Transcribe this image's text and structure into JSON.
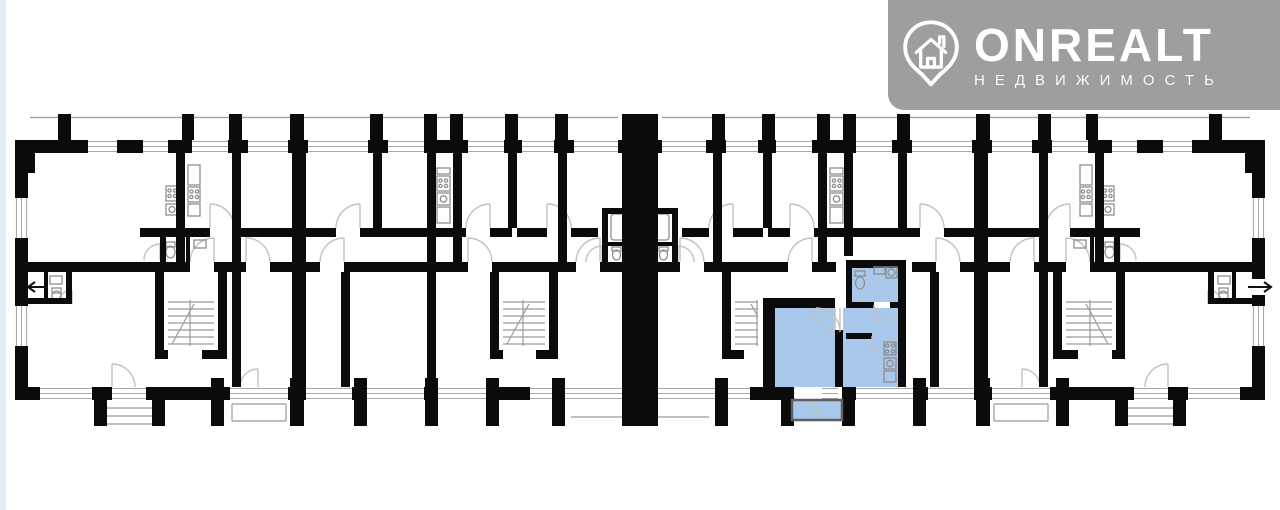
{
  "page": {
    "background_color": "#ffffff",
    "edge_strip_color": "#e4ecf6"
  },
  "watermark": {
    "brand": "ONREALT",
    "tagline": "НЕДВИЖИМОСТЬ",
    "background_color": "#9e9e9e",
    "text_color": "#ffffff",
    "icon": "location-pin-house-icon"
  },
  "floor_plan": {
    "wall_color": "#0b0b0b",
    "window_line_color": "#a9a9a9",
    "rail_line_color": "#9b9b9b",
    "door_arc_color": "#c2c2c2",
    "fixture_line_color": "#8e8e8e",
    "highlight_fill": "#a9c9ec",
    "balcony_rail_color": "#5f5f5f",
    "arrow_color": "#111111"
  }
}
